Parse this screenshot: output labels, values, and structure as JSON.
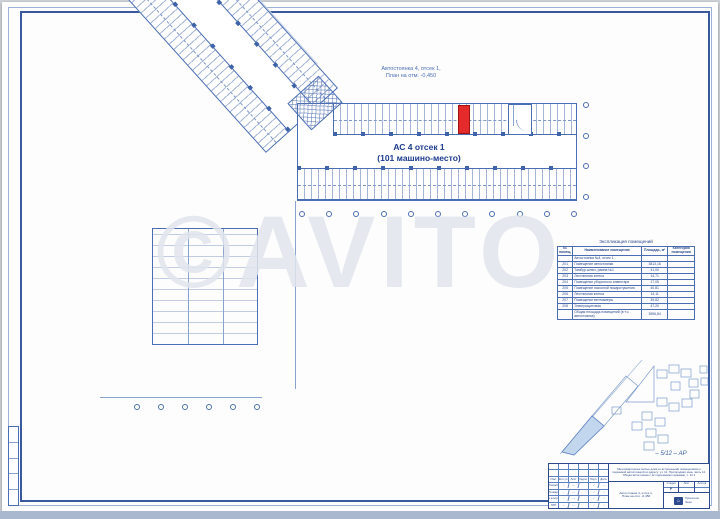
{
  "watermark": "©AVITO",
  "plan": {
    "top_caption_line1": "Автостоянка 4, отсек 1,",
    "top_caption_line2": "План на отм. -0,450",
    "area_label_line1": "АС 4  отсек 1",
    "area_label_line2": "(101 машино-место)"
  },
  "table": {
    "title": "Экспликация помещений",
    "col_num": "№ помещ.",
    "col_name": "Наименование помещения",
    "col_area": "Площадь, м²",
    "col_note": "Категория помещения",
    "rows": [
      {
        "num": "",
        "name": "Автостоянка №4, отсек 1",
        "area": "",
        "note": ""
      },
      {
        "num": "201",
        "name": "Помещение автостоянки",
        "area": "3813,16",
        "note": ""
      },
      {
        "num": "202",
        "name": "Тамбур-шлюз, рампа №1",
        "area": "41,00",
        "note": ""
      },
      {
        "num": "203",
        "name": "Лестничная клетка",
        "area": "14,71",
        "note": ""
      },
      {
        "num": "204",
        "name": "Помещение уборочного инвентаря",
        "area": "17,05",
        "note": ""
      },
      {
        "num": "205",
        "name": "Помещение насосной пожаротушения",
        "area": "40,81",
        "note": ""
      },
      {
        "num": "206",
        "name": "Лестничная клетка",
        "area": "14,11",
        "note": ""
      },
      {
        "num": "207",
        "name": "Помещение венткамеры",
        "area": "39,82",
        "note": ""
      },
      {
        "num": "208",
        "name": "Электрощитовая",
        "area": "47,20",
        "note": ""
      },
      {
        "num": "",
        "name": "Общая площадь помещений (в т.ч. автостоянка)",
        "area": "3996,84",
        "note": ""
      }
    ]
  },
  "titleblock": {
    "doc_number": "– 5/12 – АР",
    "project_description": "Многоквартирные жилые дома со встроенными помещениями и подземной автостоянкой по адресу: уч. 12, Пригородная зона, часть 12. Общая автостоянка с 12 подземными гаражами, ч. 12-1",
    "sheet_name_line1": "Автостоянка 4, отсек 1.",
    "sheet_name_line2": "План на отм. -0,450",
    "stage_label": "Стадия",
    "sheet_label": "Лист",
    "sheets_label": "Листов",
    "stage_value": "Р",
    "col_izm": "Изм.",
    "col_koluch": "Кол.уч.",
    "col_list": "Лист",
    "col_dok": "№док.",
    "col_podp": "Подп.",
    "col_data": "Дата",
    "sig_razrab": "Разраб.",
    "sig_prov": "Провер.",
    "sig_nkontr": "Н.контр.",
    "sig_gip": "ГИП",
    "org_line1": "Проектное",
    "org_line2": "бюро"
  },
  "colors": {
    "accent_red": "#e42a2a",
    "line_blue": "#4a6db3",
    "dark_blue": "#24439a"
  }
}
